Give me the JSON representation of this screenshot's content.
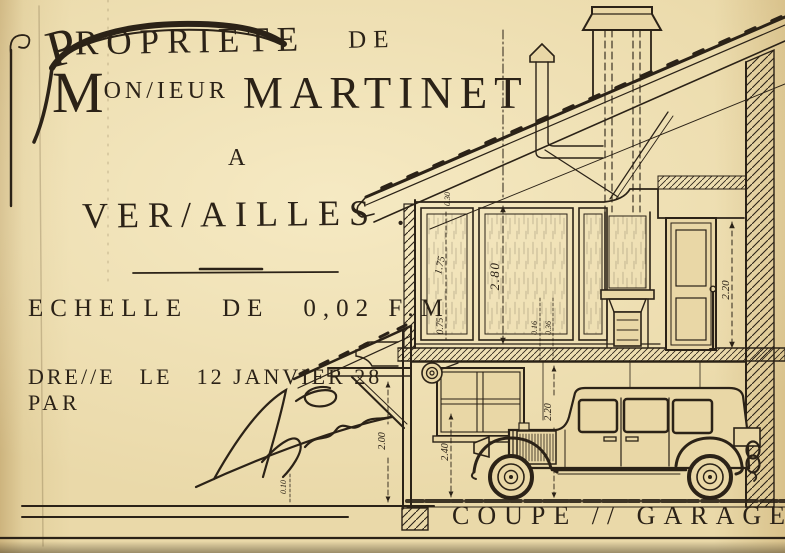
{
  "colors": {
    "paper": "#e9d7a6",
    "ink": "#2b2217"
  },
  "header": {
    "propriete_initial": "P",
    "propriete_rest": "ROPRIETE",
    "de": "DE",
    "monsieur_initial": "M",
    "monsieur_rest": "ON/IEUR",
    "owner": "MARTINET",
    "a": "A",
    "city": "VER/AILLES ."
  },
  "scale_line": {
    "label": "ECHELLE",
    "de": "DE",
    "value": "0,02 F.M"
  },
  "date_line": {
    "dresse": "DRE//E",
    "le": "LE",
    "date": "12 JANVIER 28",
    "par": "PAR"
  },
  "drawing": {
    "section_label": "COUPE // GARAGE",
    "dims": {
      "roof_gap": "0.30",
      "panel_upper": "1.75",
      "room_height": "2.80",
      "panel_lower": "0.75",
      "mantel_small": "0.16",
      "mantel_small2": "0.36",
      "door_height": "2.20",
      "garage_window": "2.40",
      "garage_front": "2.20",
      "awning_clearance": "2.00",
      "ground_step": "0.10"
    }
  }
}
